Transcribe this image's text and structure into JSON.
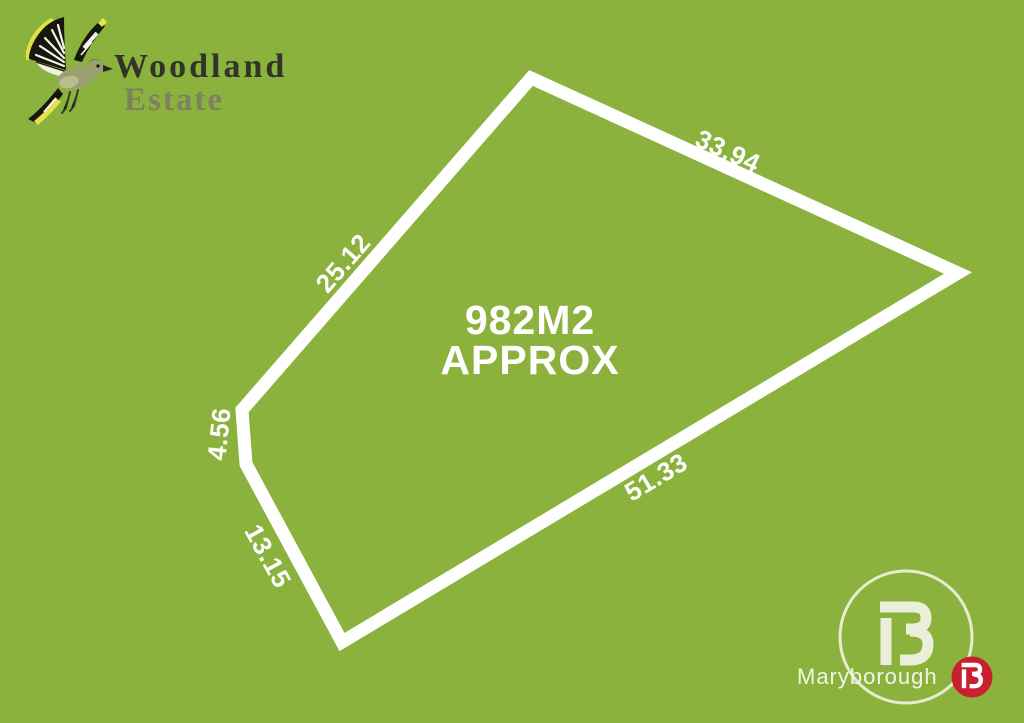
{
  "canvas": {
    "width": 1024,
    "height": 723,
    "background_color": "#8CB23E"
  },
  "brand": {
    "logo_icon": "bird",
    "name_line1": "Woodland",
    "name_line2": "Estate",
    "name_color": "#33332A",
    "sub_color": "#7E8060"
  },
  "lot": {
    "area_line1": "982M2",
    "area_line2": "APPROX",
    "outline_color": "#FFFFFF",
    "polygon_points": "531,78 958,273 342,642 246,464 242,410",
    "dimensions": [
      {
        "label": "33.94",
        "edge": "top-right"
      },
      {
        "label": "25.12",
        "edge": "upper-left"
      },
      {
        "label": "4.56",
        "edge": "left"
      },
      {
        "label": "13.15",
        "edge": "lower-left"
      },
      {
        "label": "51.33",
        "edge": "bottom-right"
      }
    ]
  },
  "agency": {
    "location": "Maryborough",
    "monogram": "B",
    "badge_color": "#C8202E",
    "mark_color": "#EAEEDA"
  }
}
